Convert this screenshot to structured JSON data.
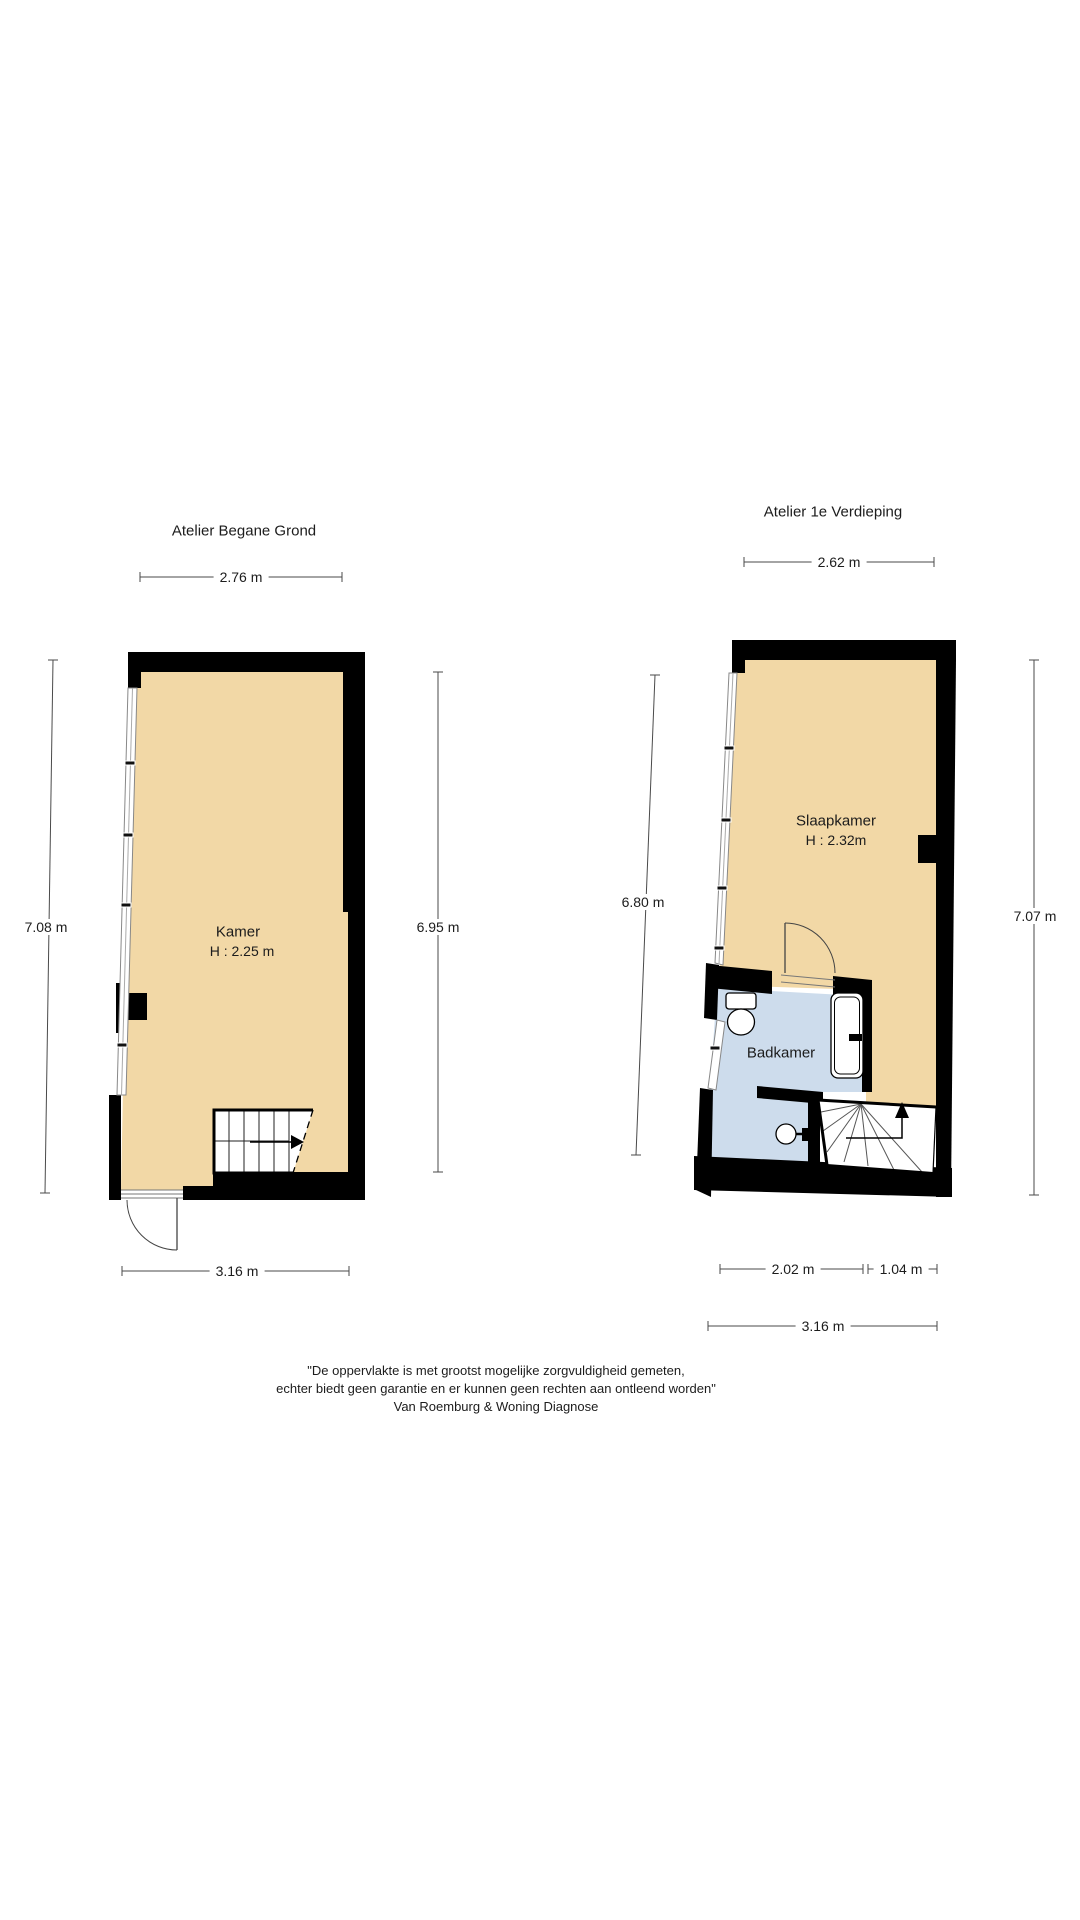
{
  "colors": {
    "floor": "#F2D8A6",
    "bathroom": "#CDDCEC",
    "wall": "#000000"
  },
  "ground_floor": {
    "title": "Atelier Begane Grond",
    "room": {
      "name": "Kamer",
      "ceiling_height": "H : 2.25 m"
    },
    "dimensions": {
      "top": "2.76 m",
      "left": "7.08 m",
      "right": "6.95 m",
      "bottom": "3.16 m"
    }
  },
  "first_floor": {
    "title": "Atelier 1e Verdieping",
    "rooms": {
      "bedroom": {
        "name": "Slaapkamer",
        "ceiling_height": "H : 2.32m"
      },
      "bathroom": {
        "name": "Badkamer"
      }
    },
    "dimensions": {
      "top": "2.62 m",
      "left": "6.80 m",
      "right": "7.07 m",
      "bottom_left": "2.02 m",
      "bottom_right": "1.04 m",
      "bottom_total": "3.16 m"
    }
  },
  "disclaimer": {
    "line1": "\"De oppervlakte is met grootst mogelijke zorgvuldigheid gemeten,",
    "line2": "echter biedt geen garantie en er kunnen geen rechten aan ontleend worden\"",
    "line3": "Van Roemburg & Woning Diagnose"
  }
}
